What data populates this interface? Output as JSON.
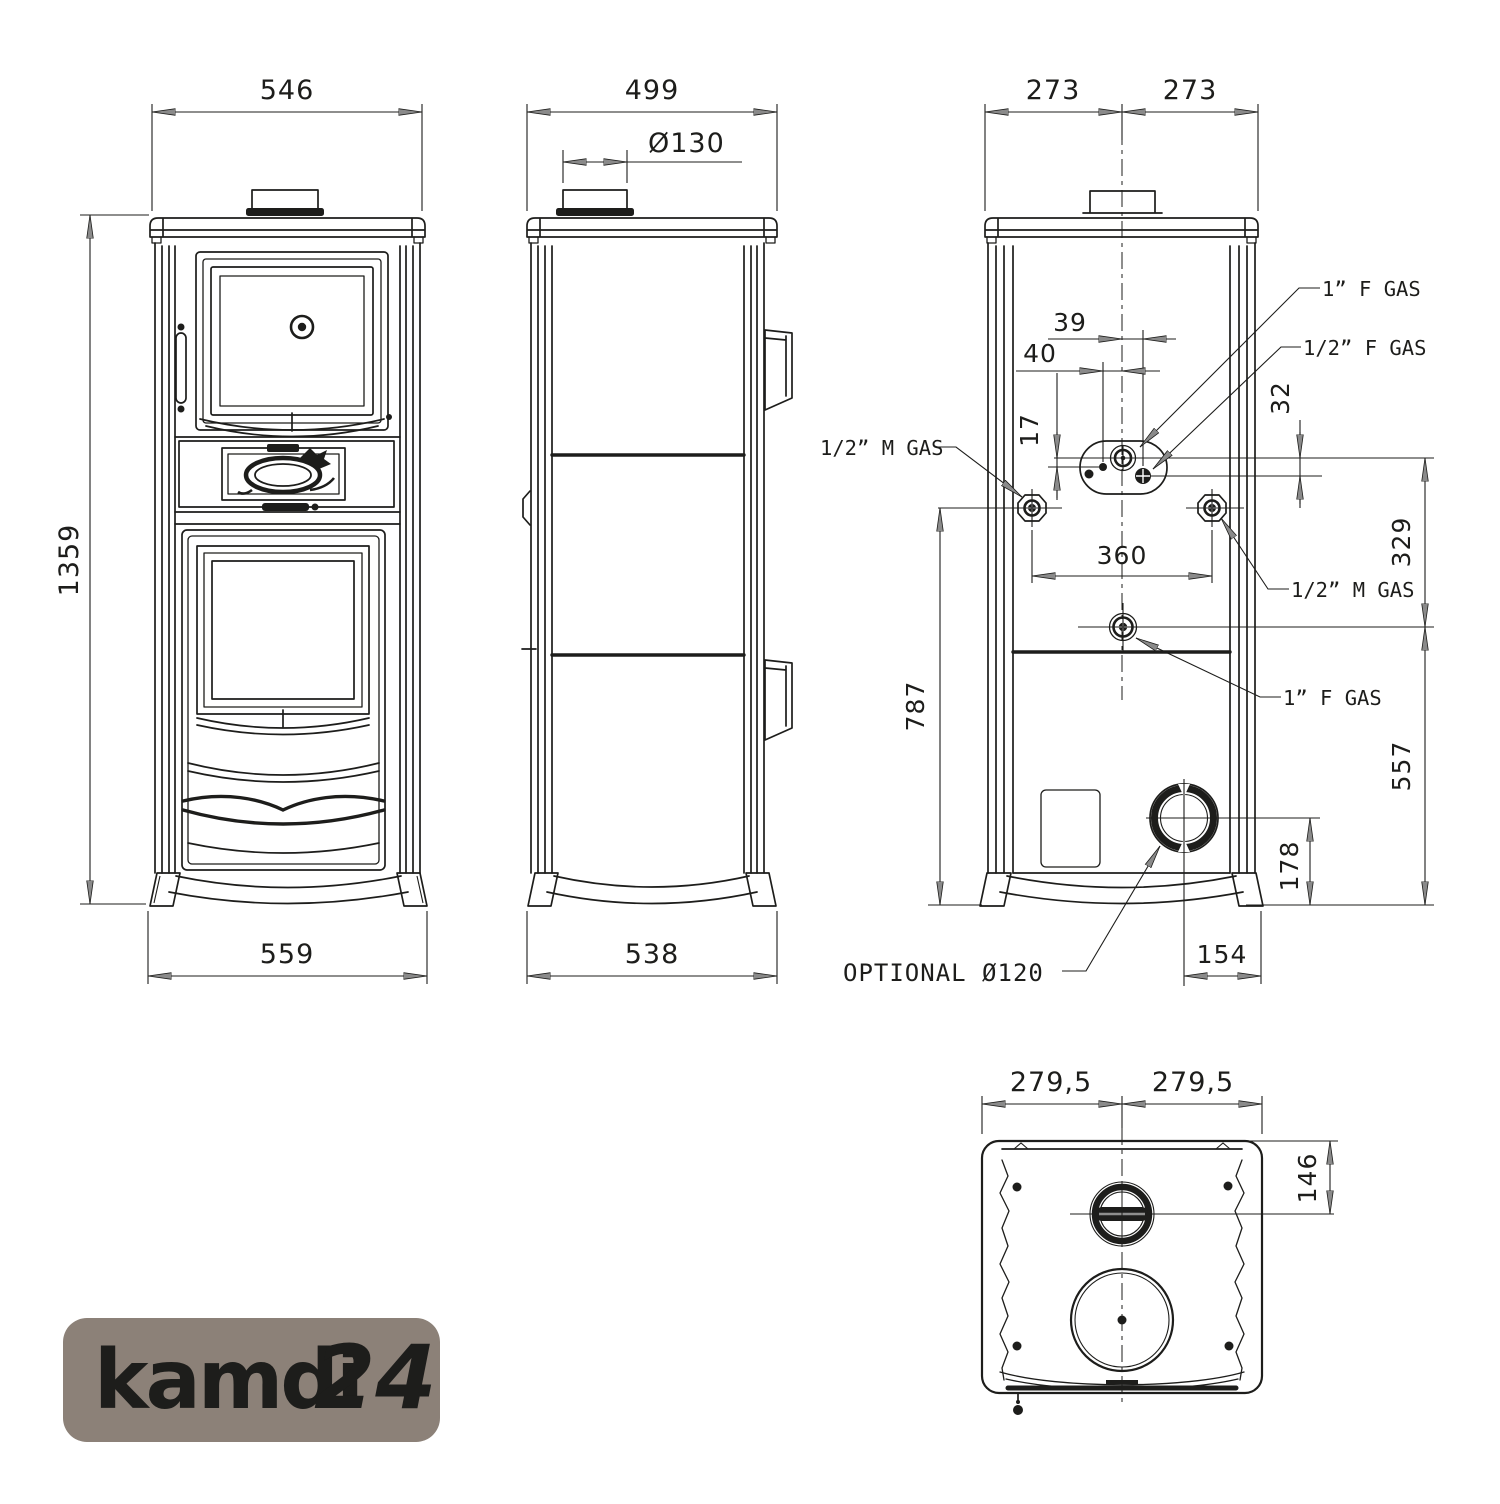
{
  "drawing": {
    "line_color": "#1d1d1b"
  },
  "front_view": {
    "top_width": "546",
    "height": "1359",
    "base_width": "559"
  },
  "side_view": {
    "top_depth": "499",
    "flue_diameter": "Ø130",
    "base_depth": "538"
  },
  "rear_view": {
    "half_left": "273",
    "half_right": "273",
    "gas_offset_39": "39",
    "pilot_offset_40": "40",
    "pilot_offset_17": "17",
    "gas_offset_32": "32",
    "connection_span_360": "360",
    "height_329": "329",
    "height_787": "787",
    "height_557": "557",
    "flue_height_178": "178",
    "flue_offset_154": "154",
    "gas_1f_top": "1” F GAS",
    "gas_12f": "1/2” F GAS",
    "gas_12m_left": "1/2” M GAS",
    "gas_12m_right": "1/2” M GAS",
    "gas_1f_bottom": "1” F GAS",
    "optional_flue": "OPTIONAL Ø120"
  },
  "bottom_view": {
    "half_left": "279,5",
    "half_right": "279,5",
    "flue_center_offset_146": "146"
  },
  "logo": {
    "brand": "kamdi",
    "suffix": "24",
    "bg_color": "#8c8178",
    "brand_color": "#8fc8ea",
    "suffix_color": "#f2a94e"
  }
}
